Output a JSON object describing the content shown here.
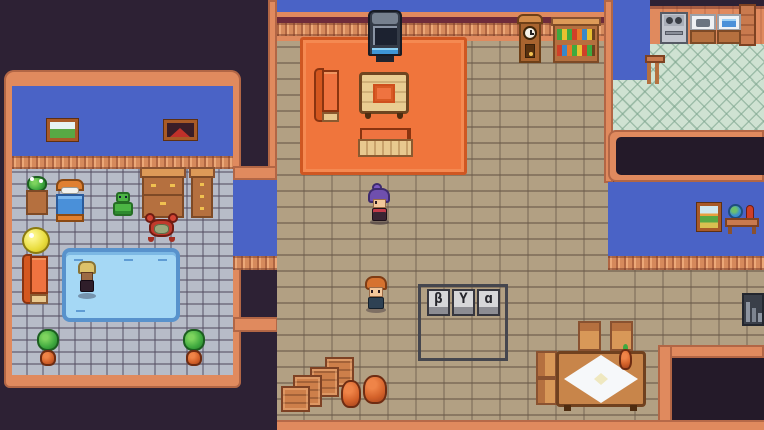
{
  "meta": {
    "type": "game-screenshot",
    "description": "Top-down pixel-art RPG house interior with bedroom, living room, kitchen and dining nook",
    "resolution": "764x430"
  },
  "button_prompt": {
    "description": "three gamepad key caps drawn on a floor sign",
    "keys": [
      {
        "glyph": "β"
      },
      {
        "glyph": "Y"
      },
      {
        "glyph": "ɑ"
      }
    ]
  },
  "characters": [
    {
      "id": "purple-haired-npc",
      "hair": "#6f4fae",
      "outfit": "#3a2433",
      "location": "center floor below orange rug"
    },
    {
      "id": "orange-haired-npc",
      "hair": "#d6722f",
      "outfit": "#2e4153",
      "location": "center floor left of button sign"
    },
    {
      "id": "blonde-swimmer-npc",
      "hair": "#dcc26a",
      "outfit": "#2f1e2a",
      "location": "standing on blue pool in left bedroom"
    }
  ],
  "rooms": {
    "left_bedroom": {
      "wall_color": "#4a63c6",
      "floor": "gray cobblestone",
      "items": [
        "landscape-picture",
        "volcano-picture",
        "flower-table",
        "bed",
        "green-robot-toy",
        "large-dresser",
        "small-dresser",
        "crab-creature",
        "yellow-ball",
        "orange-couch",
        "blue-pool",
        "potted-plant",
        "potted-plant"
      ]
    },
    "living_area": {
      "floor": "brown cobblestone",
      "rug_color": "#f0753c",
      "items": [
        "tv",
        "vertical-couch",
        "wood-table-with-cloth",
        "horizontal-couch",
        "grandfather-clock",
        "bookshelf",
        "button-sign",
        "crates",
        "clay-pots"
      ]
    },
    "kitchen": {
      "floor": "mint diamond tile",
      "items": [
        "stove",
        "sink-counter",
        "washer-counter",
        "wood-pillar",
        "railing"
      ]
    },
    "right_room": {
      "wall_color": "#4a63c6",
      "items": [
        "path-picture",
        "globe-table",
        "dining-table",
        "chairs",
        "orange-jug",
        "bottle-shelf"
      ]
    }
  },
  "colors": {
    "background": "#2d2134",
    "wall_border": "#e08a5e",
    "wall_blue": "#4a63c6",
    "floor_gray": "#b7bcc8",
    "floor_brown": "#b2a083",
    "floor_mint": "#cfe2d2",
    "rug_orange": "#f0753c",
    "wood": "#b5703f",
    "pool_blue": "#a5d8f5",
    "maroon_line": "#6e2b3a",
    "book_colors": [
      "#3fa93f",
      "#e8c030",
      "#d04028",
      "#e87828",
      "#3a88c8"
    ]
  }
}
